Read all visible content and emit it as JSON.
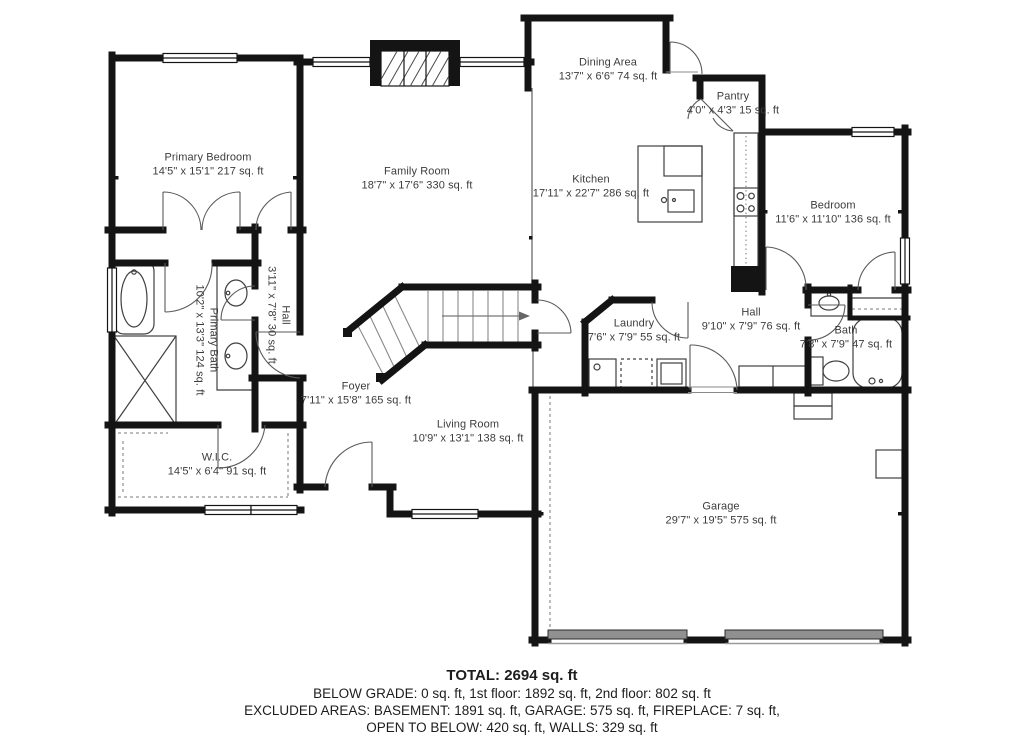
{
  "rooms": {
    "dining": {
      "name": "Dining Area",
      "dims": "13'7\" x 6'6\" 74 sq. ft"
    },
    "pantry": {
      "name": "Pantry",
      "dims": "4'0\" x 4'3\" 15 sq. ft"
    },
    "primary_bedroom": {
      "name": "Primary Bedroom",
      "dims": "14'5\" x 15'1\" 217 sq. ft"
    },
    "family_room": {
      "name": "Family Room",
      "dims": "18'7\" x 17'6\" 330 sq. ft"
    },
    "kitchen": {
      "name": "Kitchen",
      "dims": "17'11\" x 22'7\" 286 sq. ft"
    },
    "bedroom": {
      "name": "Bedroom",
      "dims": "11'6\" x 11'10\" 136 sq. ft"
    },
    "hall_left": {
      "name": "Hall",
      "dims": "3'11\" x 7'8\" 30 sq. ft"
    },
    "primary_bath": {
      "name": "Primary Bath",
      "dims": "10'2\" x 13'3\" 124 sq. ft"
    },
    "laundry": {
      "name": "Laundry",
      "dims": "7'6\" x 7'9\" 55 sq. ft"
    },
    "hall": {
      "name": "Hall",
      "dims": "9'10\" x 7'9\" 76 sq. ft"
    },
    "bath": {
      "name": "Bath",
      "dims": "7'8\" x 7'9\" 47 sq. ft"
    },
    "foyer": {
      "name": "Foyer",
      "dims": "7'11\" x 15'8\" 165 sq. ft"
    },
    "living_room": {
      "name": "Living Room",
      "dims": "10'9\" x 13'1\" 138 sq. ft"
    },
    "wic": {
      "name": "W.I.C.",
      "dims": "14'5\" x 6'4\" 91 sq. ft"
    },
    "garage": {
      "name": "Garage",
      "dims": "29'7\" x 19'5\" 575 sq. ft"
    }
  },
  "summary": {
    "total": "TOTAL: 2694 sq. ft",
    "line1": "BELOW GRADE: 0 sq. ft, 1st floor: 1892 sq. ft, 2nd floor: 802 sq. ft",
    "line2": "EXCLUDED AREAS: BASEMENT: 1891 sq. ft, GARAGE: 575 sq. ft, FIREPLACE: 7 sq. ft,",
    "line3": "OPEN TO BELOW: 420 sq. ft, WALLS: 329 sq. ft"
  },
  "colors": {
    "wall": "#141414",
    "thin_line": "#6a6a6a",
    "door_arc": "#5a5a5a",
    "fixture": "#3f3f3f",
    "garage_door": "#909090",
    "text": "#3c3c3c",
    "background": "#ffffff"
  }
}
